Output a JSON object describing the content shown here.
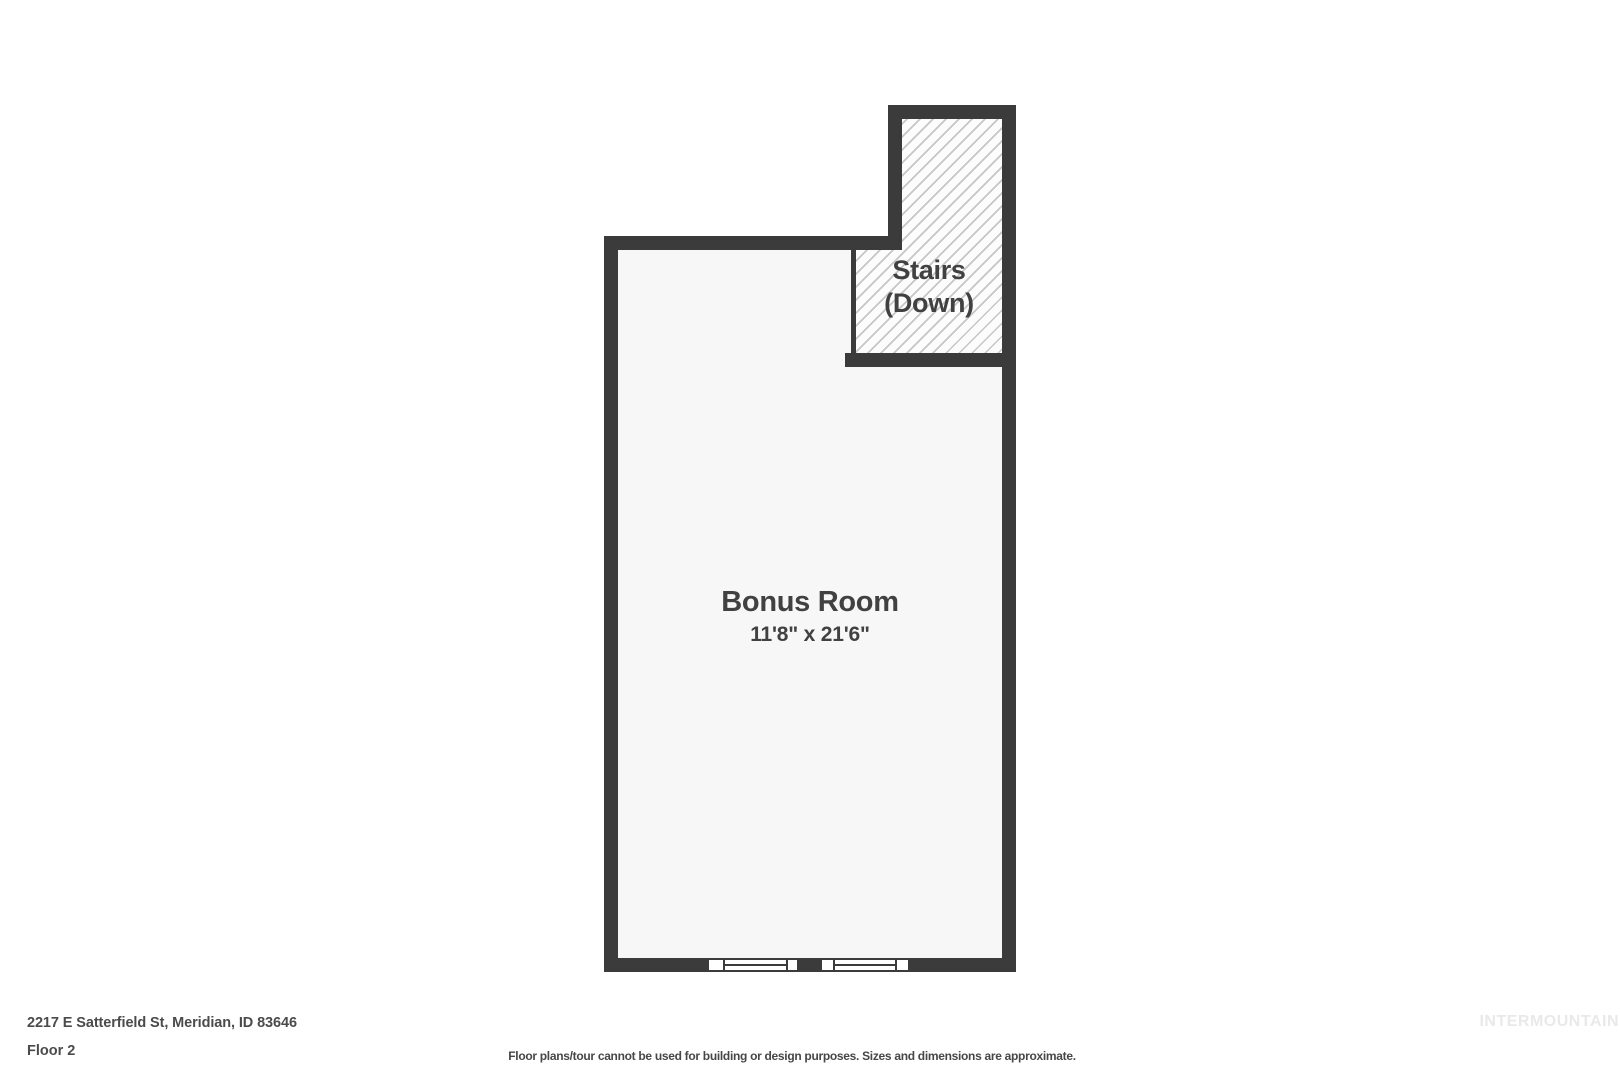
{
  "floorplan": {
    "stairs": {
      "label": "Stairs",
      "sublabel": "(Down)"
    },
    "bonus_room": {
      "name": "Bonus Room",
      "dimensions": "11'8\" x 21'6\""
    },
    "window_count": 2
  },
  "footer": {
    "address": "2217 E Satterfield St, Meridian, ID 83646",
    "floor_label": "Floor 2",
    "disclaimer": "Floor plans/tour cannot be used for building or design purposes. Sizes and dimensions are approximate."
  },
  "watermark": "INTERMOUNTAIN",
  "colors": {
    "wall": "#3b3b3b",
    "room_floor": "#f7f7f7",
    "hatch_line": "#c6c6c6",
    "label_text": "#414141",
    "footer_text": "#4b4b4b",
    "watermark_text": "#e9e9e9",
    "background": "#ffffff"
  }
}
